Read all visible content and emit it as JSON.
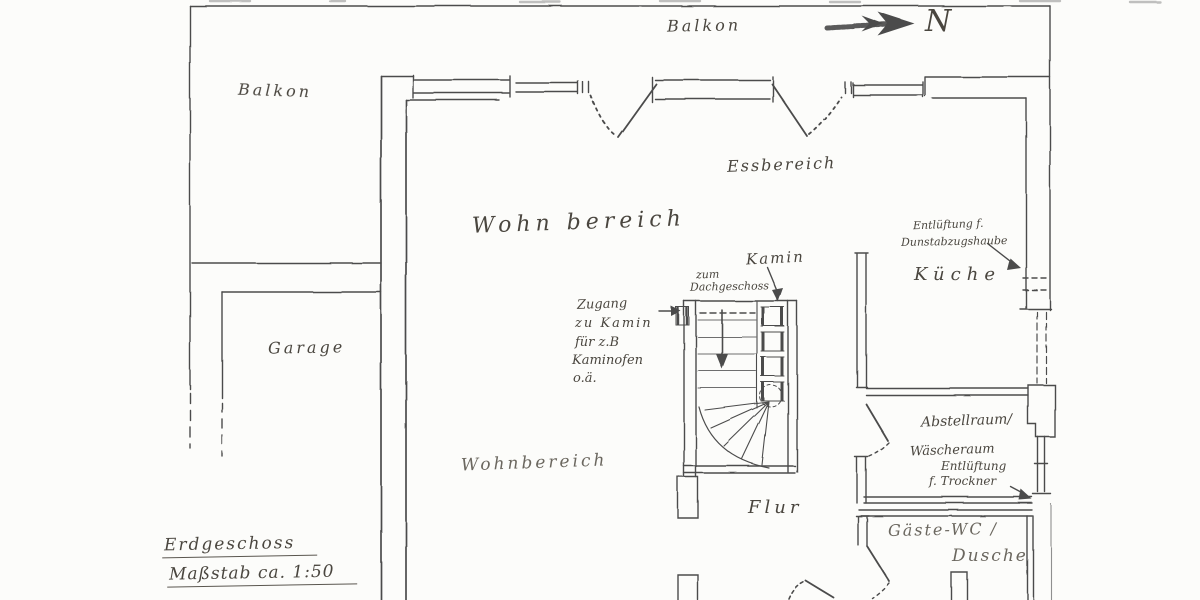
{
  "document": {
    "type": "hand-drawn floor plan (scan)",
    "title_block": {
      "line1": "Erdgeschoss",
      "line2": "Maßstab ca. 1:50"
    }
  },
  "compass": {
    "label": "N"
  },
  "colors": {
    "ink": "#4c4c4c",
    "handwriting": "#4a463f",
    "paper": "#fcfcfa"
  },
  "labels": {
    "balkon_top": "Balkon",
    "balkon_left": "Balkon",
    "essbereich": "Essbereich",
    "wohnbereich_upper": "Wohn bereich",
    "kueche": "Küche",
    "vent_kueche_1": "Entlüftung f.",
    "vent_kueche_2": "Dunstabzugshaube",
    "kamin": "Kamin",
    "stair_dest_1": "zum",
    "stair_dest_2": "Dachgeschoss",
    "zugang_1": "Zugang",
    "zugang_2": "zu Kamin",
    "zugang_3": "für z.B",
    "zugang_4": "Kaminofen",
    "zugang_5": "o.ä.",
    "garage": "Garage",
    "abstellraum": "Abstellraum/",
    "waescheraum": "Wäscheraum",
    "vent_trockner_1": "Entlüftung",
    "vent_trockner_2": "f. Trockner",
    "wohnbereich_lower": "Wohnbereich",
    "flur": "Flur",
    "gaeste_wc": "Gäste-WC /",
    "dusche": "Dusche",
    "north": "N",
    "title_line1": "Erdgeschoss",
    "title_line2": "Maßstab ca. 1:50"
  }
}
